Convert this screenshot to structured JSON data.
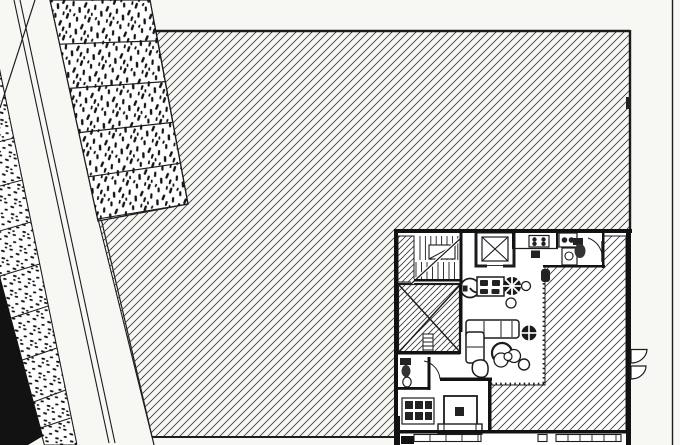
{
  "drawing": {
    "kind": "architectural-floor-plan",
    "description": "scanned black-and-white CAD site plan: diagonal road and planting strips on the left, large diagonally hatched lawn, building with stair, elevator, kitchen, bath, living-dining furniture and hatched terrace at lower right",
    "visible_text": {
      "stair_direction_label": "L"
    }
  },
  "palette": {
    "background": "#f7f7f4",
    "paper": "#ffffff",
    "ink": "#1c1c1c",
    "hatch_line": "#3f3f3f",
    "speckle": "#141414",
    "wall": "#121212"
  },
  "patterns": {
    "lawn_hatch": {
      "angle_deg": 45,
      "spacing_px": 8
    },
    "terrace_hatch": {
      "angle_deg": 45,
      "spacing_px": 8
    },
    "void_hatch": {
      "angle_deg": 45,
      "spacing_px": 6
    },
    "planting_speckle": "irregular dark dashes on white panels"
  },
  "legend": {
    "regions": [
      "left-planting-strip",
      "black-shadow-band",
      "road",
      "curb-lines",
      "median-planting-strip",
      "main-lawn",
      "building",
      "terrace",
      "void-room"
    ],
    "fixtures": [
      "staircase",
      "elevator",
      "stove",
      "sink",
      "upper-bathroom",
      "toilet",
      "dining-table",
      "dining-chairs",
      "l-sofa",
      "coffee-table",
      "fan-stool",
      "pebble-seat",
      "plant-rings",
      "bed",
      "cabinet-grid",
      "lower-bathroom",
      "windows",
      "awning-symbols",
      "hedge-dotted-line"
    ]
  }
}
